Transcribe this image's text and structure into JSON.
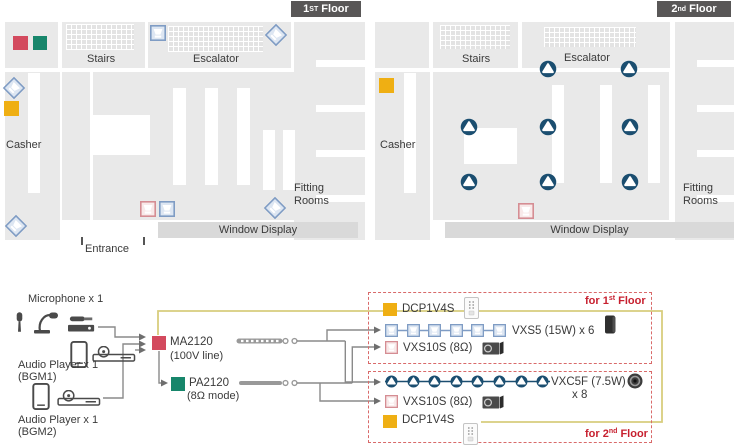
{
  "floor1": {
    "badge": {
      "num": "1",
      "sup": "ST",
      "rest": " Floor"
    },
    "stairs": "Stairs",
    "escalator": "Escalator",
    "casher": "Casher",
    "fitting_rooms": "Fitting Rooms",
    "window_display": "Window Display",
    "entrance": "Entrance"
  },
  "floor2": {
    "badge": {
      "num": "2",
      "sup": "nd",
      "rest": " Floor"
    },
    "stairs": "Stairs",
    "escalator": "Escalator",
    "casher": "Casher",
    "fitting_rooms": "Fitting Rooms",
    "window_display": "Window Display"
  },
  "diagram": {
    "mic_label": "Microphone x 1",
    "bgm1_label": "Audio Player x 1",
    "bgm1_sub": "(BGM1)",
    "bgm2_label": "Audio Player x 1",
    "bgm2_sub": "(BGM2)",
    "ma": {
      "name": "MA2120",
      "mode": "(100V line)"
    },
    "pa": {
      "name": "PA2120",
      "mode": "(8Ω mode)"
    },
    "zone1": {
      "title_pre": "for 1",
      "title_sup": "st",
      "title_rest": " Floor",
      "controller": "DCP1V4S",
      "main_label": "VXS5 (15W) x 6",
      "main_count": 6,
      "sub_label": "VXS10S (8Ω)"
    },
    "zone2": {
      "title_pre": "for 2",
      "title_sup": "nd",
      "title_rest": " Floor",
      "controller": "DCP1V4S",
      "main_label": "VXC5F (7.5W)",
      "main_label2": "x 8",
      "main_count": 8,
      "sub_label": "VXS10S (8Ω)"
    }
  },
  "colors": {
    "map_gray": "#e9e9e9",
    "badge_bg": "#595757",
    "accent_red": "#d34a5e",
    "accent_green": "#17866b",
    "accent_yellow": "#efaf13",
    "speaker_blue": "#7f9cc4",
    "speaker_pink": "#d58d93",
    "ceiling_navy": "#1b4e70",
    "zone_border": "#d96a6a",
    "zone_title_red": "#c7202f",
    "cable_yellow": "#d8cd7d",
    "line_gray": "#8a8a8a"
  },
  "icons": [
    "wall-speaker-icon",
    "ceiling-speaker-icon",
    "subwoofer-marker-icon",
    "amp-marker",
    "wall-controller-icon",
    "microphone-icon",
    "audio-player-icon",
    "cable-icon",
    "speaker-product-icon"
  ]
}
